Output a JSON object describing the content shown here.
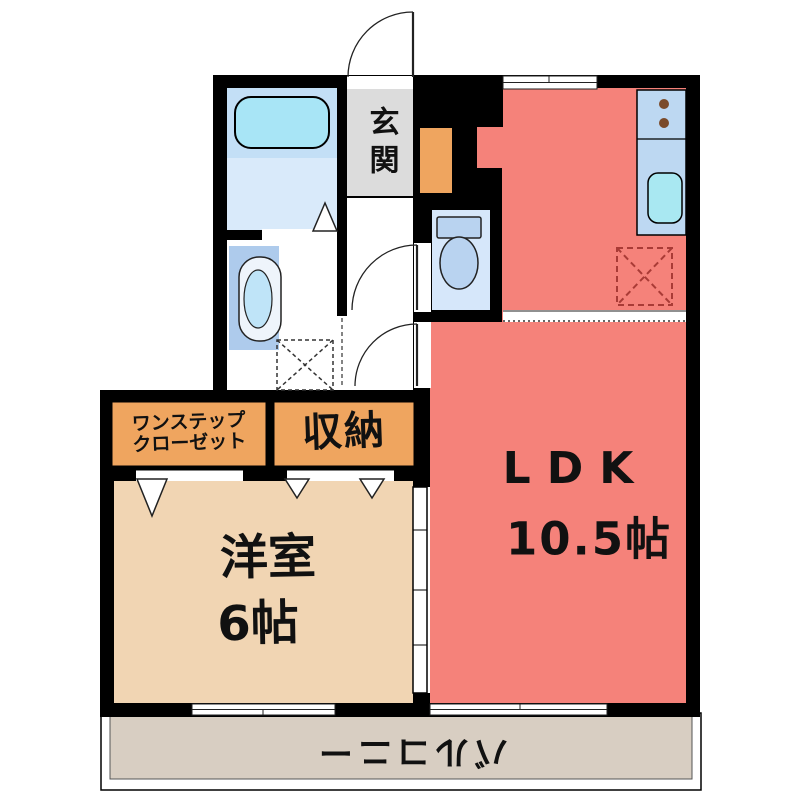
{
  "floor_plan": {
    "rooms": {
      "genkan": {
        "label": "玄関"
      },
      "ldk": {
        "label": "LDK",
        "size": "10.5帖"
      },
      "western_room": {
        "label": "洋室",
        "size": "6帖"
      },
      "one_step_closet": {
        "line1": "ワンステップ",
        "line2": "クローゼット"
      },
      "storage": {
        "label": "収納"
      },
      "balcony": {
        "label": "バルコニー"
      }
    },
    "colors": {
      "wall": "#000000",
      "ldk": "#F5827A",
      "western_room": "#F1D5B3",
      "closet_box": "#EFA55F",
      "balcony": "#D8CEC2",
      "genkan": "#DCDCDC",
      "bathroom_upper": "#C3DFF6",
      "bathroom_lower": "#D9EAFA",
      "toilet_room": "#D6E7FA",
      "kitchen_counter": "#BDD8F2",
      "bathtub": "#A8E5F6",
      "kitchen_sink": "#A9E8F2",
      "washbasin": "#AECBEC",
      "refrigerator_dash": "#A93B36",
      "burner": "#7A4A2A"
    },
    "fixtures": {
      "bathtub": "bathtub",
      "toilet": "toilet",
      "washbasin": "washbasin",
      "washing_machine_space": "washing-machine-space",
      "refrigerator_space": "refrigerator-space",
      "kitchen_sink": "kitchen-sink",
      "stove_burners": "stove-burners",
      "shoe_cabinet": "shoe-cabinet"
    }
  }
}
